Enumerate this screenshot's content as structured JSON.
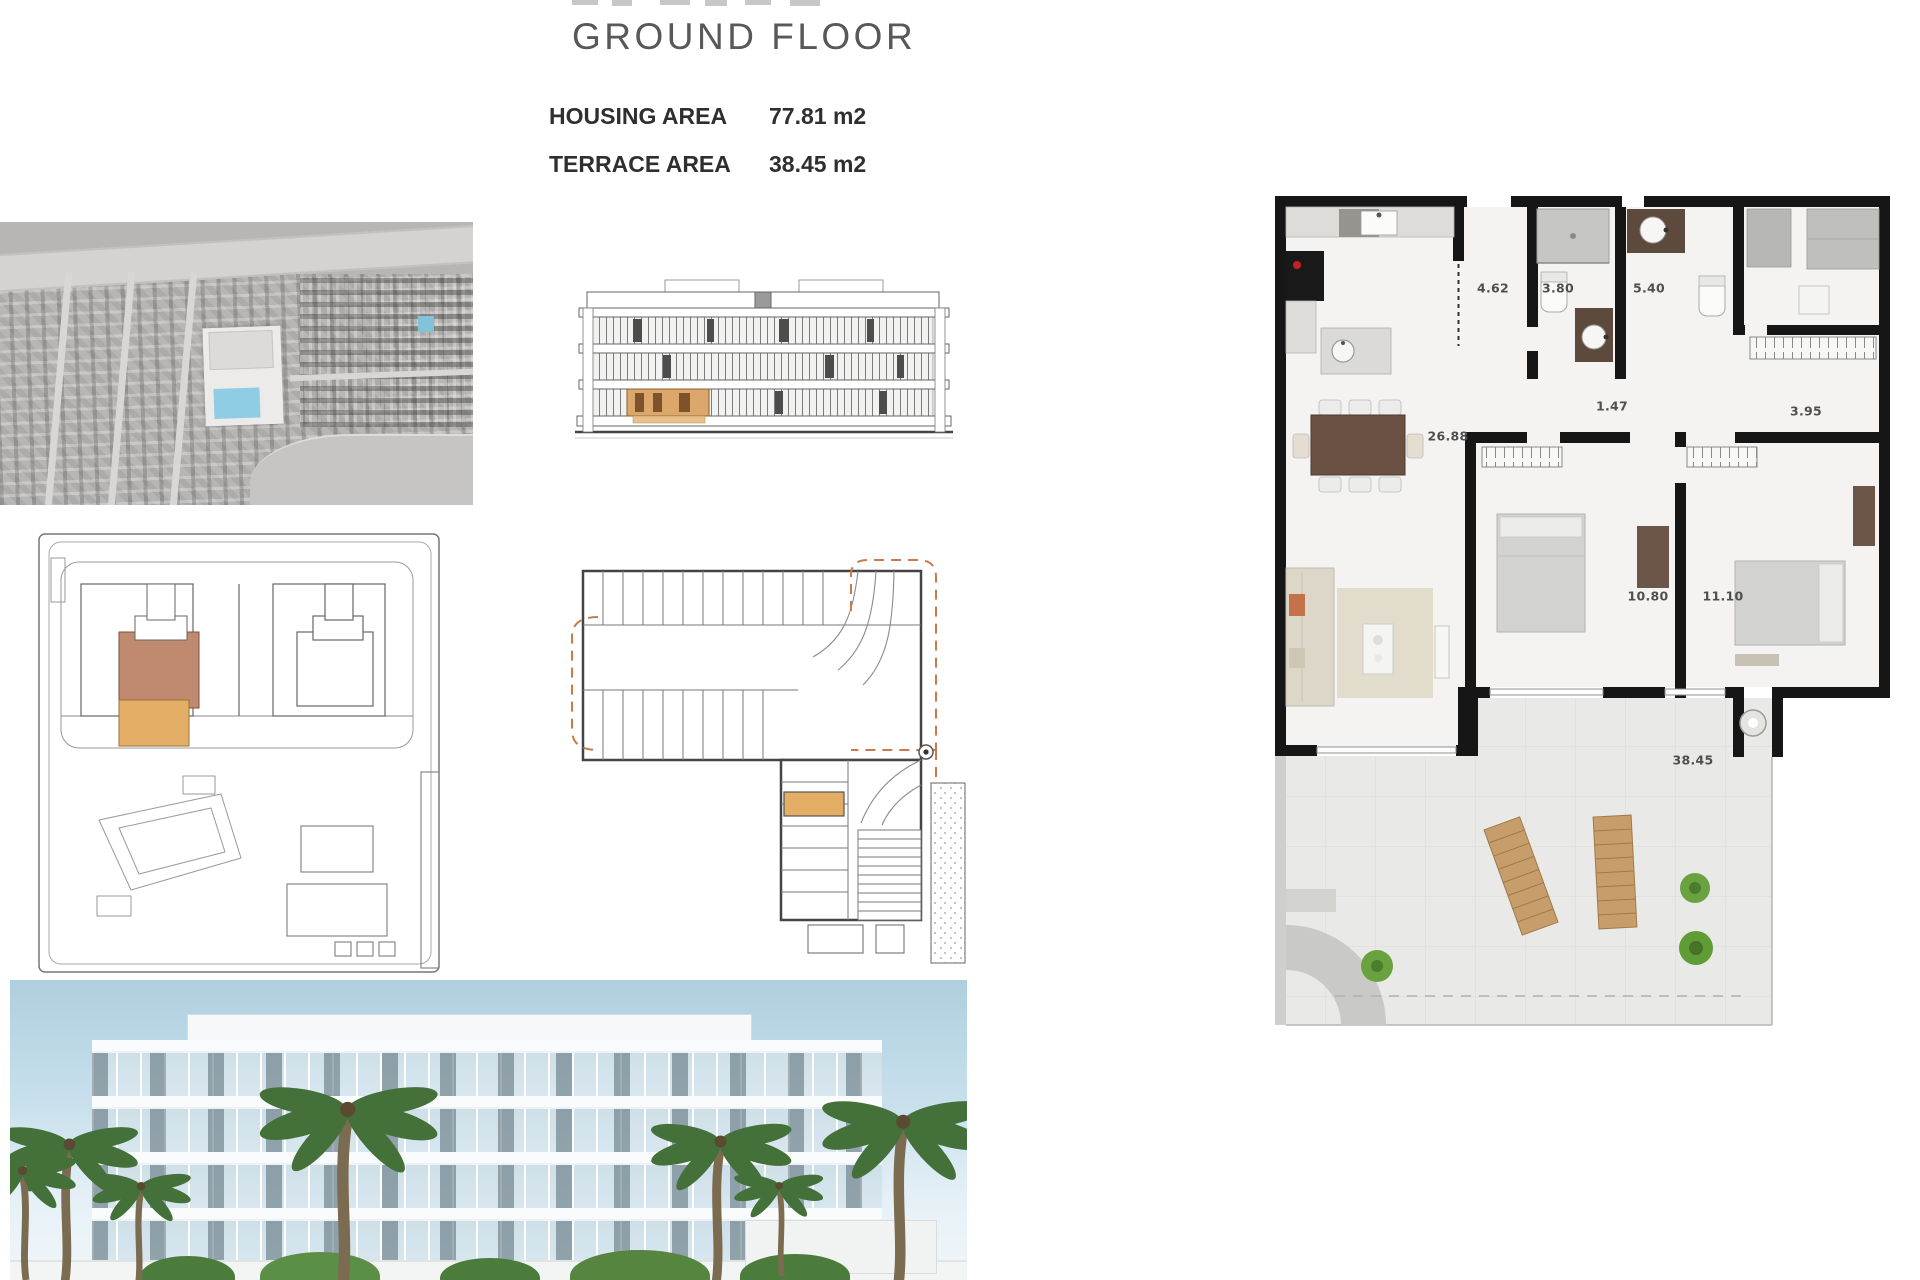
{
  "header": {
    "title": "GROUND FLOOR",
    "areas": [
      {
        "label": "HOUSING AREA",
        "value": "77.81 m2"
      },
      {
        "label": "TERRACE AREA",
        "value": "38.45 m2"
      }
    ]
  },
  "apartment_plan": {
    "measurements": {
      "hall": "4.62",
      "bathroom_1": "3.80",
      "bathroom_2": "5.40",
      "corridor": "1.47",
      "wardrobe": "3.95",
      "living_kitchen": "26.88",
      "bedroom_1": "10.80",
      "bedroom_2": "11.10",
      "terrace": "38.45"
    }
  },
  "colors": {
    "highlight_orange": "#e5ae67",
    "highlight_red": "#bf8a70",
    "elevation_unit_orange": "#dca76b",
    "plan_dash_orange": "#cc7a4a",
    "wall_black": "#161616",
    "pool_blue": "#8fcde4",
    "sky_blue": "#aecfdf",
    "plant_green": "#6aa23f"
  }
}
